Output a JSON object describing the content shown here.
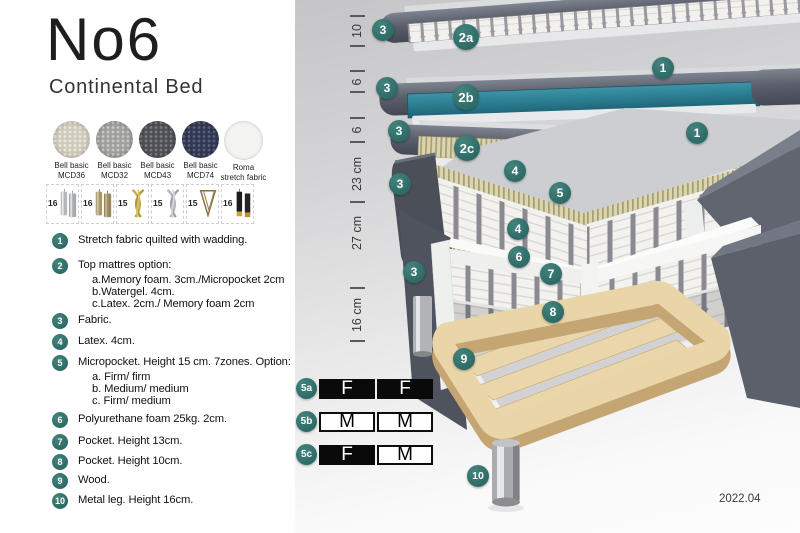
{
  "header": {
    "title": "No6",
    "subtitle": "Continental Bed"
  },
  "fabrics": [
    {
      "line1": "Bell basic",
      "line2": "MCD36",
      "base": "#cfcabb",
      "dot": "#ece8dc",
      "textured": true
    },
    {
      "line1": "Bell basic",
      "line2": "MCD32",
      "base": "#9fa09e",
      "dot": "#c9cac8",
      "textured": true
    },
    {
      "line1": "Bell basic",
      "line2": "MCD43",
      "base": "#4e4f54",
      "dot": "#7a7b80",
      "textured": true
    },
    {
      "line1": "Bell basic",
      "line2": "MCD74",
      "base": "#323850",
      "dot": "#5a6183",
      "textured": true
    },
    {
      "line1": "Roma",
      "line2": "stretch fabric",
      "base": "#f3f3f2",
      "dot": "",
      "textured": false
    }
  ],
  "legs": [
    {
      "size": "16",
      "style": "silver-cylinder"
    },
    {
      "size": "16",
      "style": "brass-cylinder"
    },
    {
      "size": "15",
      "style": "gold-twist"
    },
    {
      "size": "15",
      "style": "silver-twist"
    },
    {
      "size": "15",
      "style": "hairpin"
    },
    {
      "size": "16",
      "style": "black-gold-cylinder"
    }
  ],
  "legend": [
    {
      "num": "1",
      "text": "Stretch fabric quilted with wadding.",
      "subs": []
    },
    {
      "num": "2",
      "text": "Top mattres option:",
      "subs": [
        "a.Memory foam. 3cm./Micropocket 2cm",
        "b.Watergel. 4cm.",
        "c.Latex. 2cm./ Memory foam 2cm"
      ]
    },
    {
      "num": "3",
      "text": "Fabric.",
      "subs": []
    },
    {
      "num": "4",
      "text": "Latex. 4cm.",
      "subs": []
    },
    {
      "num": "5",
      "text": "Micropocket. Height 15 cm. 7zones. Option:",
      "subs": [
        "a. Firm/ firm",
        "b. Medium/ medium",
        "c. Firm/ medium"
      ]
    },
    {
      "num": "6",
      "text": "Polyurethane foam 25kg. 2cm.",
      "subs": []
    },
    {
      "num": "7",
      "text": "Pocket. Height 13cm.",
      "subs": []
    },
    {
      "num": "8",
      "text": "Pocket. Height 10cm.",
      "subs": []
    },
    {
      "num": "9",
      "text": "Wood.",
      "subs": []
    },
    {
      "num": "10",
      "text": "Metal leg. Height 16cm.",
      "subs": []
    }
  ],
  "diagram": {
    "badges": [
      {
        "label": "3",
        "x": 88,
        "y": 30
      },
      {
        "label": "2a",
        "x": 171,
        "y": 37
      },
      {
        "label": "1",
        "x": 368,
        "y": 68
      },
      {
        "label": "3",
        "x": 92,
        "y": 88
      },
      {
        "label": "2b",
        "x": 171,
        "y": 97
      },
      {
        "label": "3",
        "x": 104,
        "y": 131
      },
      {
        "label": "2c",
        "x": 172,
        "y": 148
      },
      {
        "label": "1",
        "x": 402,
        "y": 133
      },
      {
        "label": "3",
        "x": 105,
        "y": 184
      },
      {
        "label": "4",
        "x": 220,
        "y": 171
      },
      {
        "label": "5",
        "x": 265,
        "y": 193
      },
      {
        "label": "4",
        "x": 223,
        "y": 229
      },
      {
        "label": "6",
        "x": 224,
        "y": 257
      },
      {
        "label": "3",
        "x": 119,
        "y": 272
      },
      {
        "label": "7",
        "x": 256,
        "y": 274
      },
      {
        "label": "8",
        "x": 258,
        "y": 312
      },
      {
        "label": "9",
        "x": 169,
        "y": 359
      },
      {
        "label": "10",
        "x": 183,
        "y": 476
      }
    ],
    "dimensions": [
      {
        "label": "10",
        "y": 31
      },
      {
        "label": "6",
        "y": 82
      },
      {
        "label": "6",
        "y": 130
      },
      {
        "label": "23 cm",
        "y": 174
      },
      {
        "label": "27 cm",
        "y": 233
      },
      {
        "label": "16 cm",
        "y": 315
      }
    ],
    "ticks": [
      16,
      46,
      71,
      92,
      118,
      142,
      202,
      288,
      341
    ],
    "firmness_rows": [
      {
        "badge": "5a",
        "cells": [
          {
            "letter": "F",
            "filled": true
          },
          {
            "letter": "F",
            "filled": true
          }
        ]
      },
      {
        "badge": "5b",
        "cells": [
          {
            "letter": "M",
            "filled": false
          },
          {
            "letter": "M",
            "filled": false
          }
        ]
      },
      {
        "badge": "5c",
        "cells": [
          {
            "letter": "F",
            "filled": true
          },
          {
            "letter": "M",
            "filled": false
          }
        ]
      }
    ],
    "version": "2022.04"
  },
  "colors": {
    "badge_teal": "#2e6b67",
    "badge_highlight": "#44837d",
    "layer_teal": "#2d8094",
    "cover_gray": "#5a5f6a",
    "micropocket_yellow": "#dbd5ae",
    "wood": "#ead5a9"
  }
}
